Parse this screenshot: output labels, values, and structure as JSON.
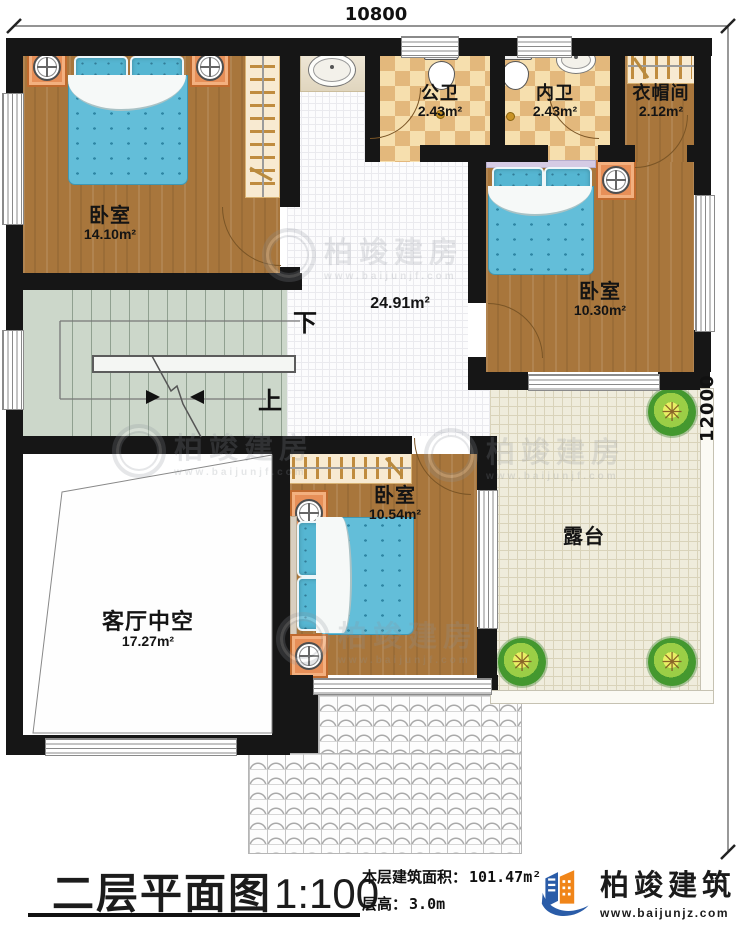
{
  "dimensions": {
    "top": "10800",
    "right": "12000"
  },
  "rooms": {
    "bedroom_top_left": {
      "name": "卧室",
      "area": "14.10m²"
    },
    "public_bath": {
      "name": "公卫",
      "area": "2.43m²"
    },
    "private_bath": {
      "name": "内卫",
      "area": "2.43m²"
    },
    "cloakroom": {
      "name": "衣帽间",
      "area": "2.12m²"
    },
    "bedroom_right": {
      "name": "卧室",
      "area": "10.30m²"
    },
    "hall": {
      "area": "24.91m²"
    },
    "bedroom_bottom": {
      "name": "卧室",
      "area": "10.54m²"
    },
    "living_void": {
      "name": "客厅中空",
      "area": "17.27m²"
    },
    "terrace": {
      "name": "露台"
    }
  },
  "stairs": {
    "down": "下",
    "up": "上"
  },
  "titlebar": {
    "title": "二层平面图",
    "scale": "1:100",
    "floor_area_label": "本层建筑面积：",
    "floor_area_value": "101.47m²",
    "floor_height_label": "层高：",
    "floor_height_value": "3.0m",
    "brand_name": "柏竣建筑",
    "brand_url": "www.baijunjz.com"
  },
  "watermark": {
    "text": "柏竣建房",
    "url": "www.baijunjf.com"
  },
  "colors": {
    "brand_blue": "#2a5ca8",
    "brand_orange": "#f08519",
    "wall": "#161616"
  }
}
